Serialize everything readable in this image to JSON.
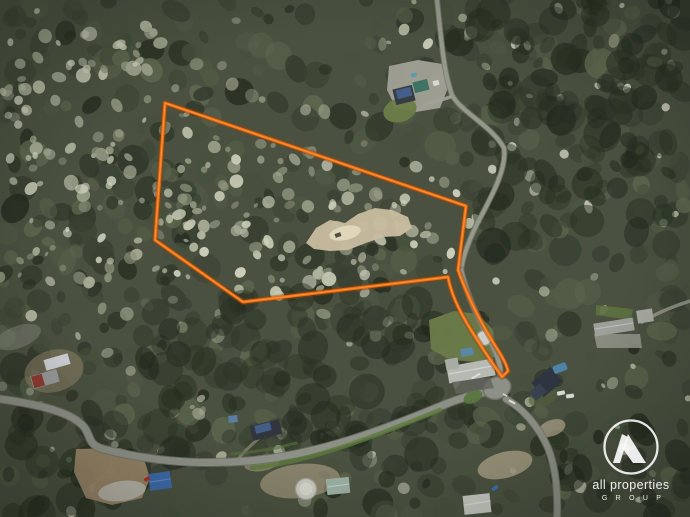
{
  "title": "Aerial drone photograph of a wooded acreage property with an orange lot-boundary overlay",
  "watermark": {
    "icon": "all-properties-a-monogram-icon",
    "line1": "all properties",
    "line2": "G R O U P",
    "color": "#ffffff",
    "circle": {
      "cx": 631,
      "cy": 447,
      "r": 26.5
    }
  },
  "scene": {
    "width": 690,
    "height": 517,
    "base_color": "#4a5140",
    "forest": {
      "dark": {
        "count": 560,
        "palette": [
          "#262d20",
          "#2f372a",
          "#3a4233",
          "#46503c",
          "#525c46",
          "#5f6950"
        ],
        "rmin": 5,
        "rmax": 16,
        "omin": 0.4,
        "omax": 0.85
      },
      "pale": {
        "count": 340,
        "palette": [
          "#8b917b",
          "#9ea48c",
          "#b2b69f",
          "#c5c8b2",
          "#d2d4c0"
        ],
        "rmin": 2.5,
        "rmax": 7.5,
        "omin": 0.5,
        "omax": 0.95
      },
      "deep": {
        "count": 240,
        "palette": [
          "#1f261c",
          "#27301f",
          "#2b3326"
        ],
        "rmin": 7,
        "rmax": 18,
        "omin": 0.3,
        "omax": 0.6
      }
    },
    "lot_polygon": [
      [
        165,
        103
      ],
      [
        466,
        206
      ],
      [
        458,
        270
      ],
      [
        448,
        277
      ],
      [
        243,
        302
      ],
      [
        155,
        240
      ]
    ],
    "boundary": {
      "name": "property-boundary",
      "path": "M165,103 L466,206 L458,270 C466,293 478,317 491,339 C498,350 506,362 508,371 L502,377 C493,364 482,348 471,330 C461,314 451,294 448,277 L243,302 L155,240 Z",
      "color": "#e96a0d",
      "glow": "#9c4507",
      "highlight": "#ff9a45"
    },
    "features": [
      {
        "name": "clearing-top-house-yard",
        "type": "polygon",
        "points": [
          [
            389,
            66
          ],
          [
            418,
            60
          ],
          [
            442,
            64
          ],
          [
            448,
            88
          ],
          [
            440,
            108
          ],
          [
            416,
            112
          ],
          [
            396,
            108
          ],
          [
            387,
            90
          ]
        ],
        "fill": "#a5a499",
        "opacity": 0.92
      },
      {
        "name": "clearing-lot-sand-patch",
        "type": "polygon",
        "points": [
          [
            306,
            243
          ],
          [
            316,
            228
          ],
          [
            330,
            220
          ],
          [
            345,
            223
          ],
          [
            358,
            214
          ],
          [
            375,
            208
          ],
          [
            392,
            210
          ],
          [
            408,
            217
          ],
          [
            412,
            228
          ],
          [
            400,
            236
          ],
          [
            383,
            237
          ],
          [
            366,
            243
          ],
          [
            348,
            250
          ],
          [
            330,
            251
          ],
          [
            314,
            249
          ]
        ],
        "fill": "#c8bd9f",
        "opacity": 0.95
      },
      {
        "name": "clearing-lot-sand-bright",
        "type": "ellipse",
        "cx": 345,
        "cy": 233,
        "rx": 16,
        "ry": 7,
        "rot": -12,
        "fill": "#e3dabf",
        "opacity": 0.9
      },
      {
        "name": "lot-vehicle",
        "type": "rect",
        "cx": 338,
        "cy": 235,
        "w": 6,
        "h": 4,
        "rot": -20,
        "fill": "#4a463e",
        "opacity": 0.95
      },
      {
        "name": "clearing-left-sheds",
        "type": "ellipse",
        "cx": 54,
        "cy": 371,
        "rx": 30,
        "ry": 21,
        "rot": -15,
        "fill": "#8b7e65",
        "opacity": 0.6
      },
      {
        "name": "clearing-bottom-left-dirt",
        "type": "polygon",
        "points": [
          [
            76,
            449
          ],
          [
            120,
            448
          ],
          [
            143,
            456
          ],
          [
            150,
            478
          ],
          [
            142,
            498
          ],
          [
            112,
            505
          ],
          [
            86,
            498
          ],
          [
            74,
            472
          ]
        ],
        "fill": "#9f8a6b",
        "opacity": 0.9
      },
      {
        "name": "clearing-bottom-left-rubble",
        "type": "ellipse",
        "cx": 122,
        "cy": 491,
        "rx": 24,
        "ry": 10,
        "rot": -8,
        "fill": "#b6b5ab",
        "opacity": 0.9
      },
      {
        "name": "clearing-bottom-center",
        "type": "ellipse",
        "cx": 300,
        "cy": 481,
        "rx": 40,
        "ry": 17,
        "rot": -6,
        "fill": "#a2977d",
        "opacity": 0.7
      },
      {
        "name": "clearing-bottom-center-2",
        "type": "ellipse",
        "cx": 262,
        "cy": 463,
        "rx": 18,
        "ry": 8,
        "rot": -10,
        "fill": "#ab9f85",
        "opacity": 0.55
      },
      {
        "name": "clearing-bottom-right",
        "type": "ellipse",
        "cx": 505,
        "cy": 465,
        "rx": 28,
        "ry": 13,
        "rot": -14,
        "fill": "#a89d83",
        "opacity": 0.8
      },
      {
        "name": "clearing-junction-gravel",
        "type": "ellipse",
        "cx": 552,
        "cy": 428,
        "rx": 14,
        "ry": 8,
        "rot": -20,
        "fill": "#b0a58b",
        "opacity": 0.7
      },
      {
        "name": "clearing-right-mid-driveway",
        "type": "polygon",
        "points": [
          [
            594,
            334
          ],
          [
            640,
            334
          ],
          [
            642,
            348
          ],
          [
            597,
            348
          ]
        ],
        "fill": "#8f9187",
        "opacity": 0.9
      },
      {
        "name": "clearing-left-edge",
        "type": "ellipse",
        "cx": 18,
        "cy": 337,
        "rx": 24,
        "ry": 11,
        "rot": -20,
        "fill": "#8c8f81",
        "opacity": 0.45
      },
      {
        "name": "lawn-top-house",
        "type": "ellipse",
        "cx": 400,
        "cy": 110,
        "rx": 17,
        "ry": 12,
        "rot": -18,
        "fill": "#6d7d49",
        "opacity": 0.95
      },
      {
        "name": "lawn-mid-house",
        "type": "polygon",
        "points": [
          [
            429,
            320
          ],
          [
            454,
            311
          ],
          [
            478,
            314
          ],
          [
            493,
            330
          ],
          [
            496,
            356
          ],
          [
            482,
            362
          ],
          [
            450,
            360
          ],
          [
            431,
            349
          ]
        ],
        "fill": "#6b7b49",
        "opacity": 0.97
      },
      {
        "name": "lawn-right-mid",
        "type": "polygon",
        "points": [
          [
            596,
            305
          ],
          [
            633,
            309
          ],
          [
            631,
            320
          ],
          [
            596,
            315
          ]
        ],
        "fill": "#5e7040",
        "opacity": 0.9
      },
      {
        "name": "lawn-bottom-right-house",
        "type": "ellipse",
        "cx": 543,
        "cy": 397,
        "rx": 15,
        "ry": 9,
        "rot": -20,
        "fill": "#535f3c",
        "opacity": 0.6
      },
      {
        "name": "road-main",
        "type": "road",
        "d": "M0,399 C50,406 74,415 84,427 C91,436 88,445 103,449 C150,461 200,465 248,461 C320,455 388,428 446,404 C458,399 472,395 486,392",
        "w": 7,
        "color": "#8d9086",
        "casing": "#6e7267"
      },
      {
        "name": "road-se-branch",
        "type": "road",
        "d": "M506,399 C522,408 538,425 548,448 C556,468 558,492 557,517",
        "w": 6,
        "color": "#8a8d83",
        "casing": "#6e7267"
      },
      {
        "name": "track-north",
        "type": "road",
        "d": "M437,0 C441,35 443,70 452,95 C461,112 492,126 504,148 C507,168 492,196 478,222 C469,240 463,256 461,270",
        "w": 4,
        "color": "#9a9d90",
        "casing": "#777b6e",
        "opacity": 0.9
      },
      {
        "name": "driveway-corridor",
        "type": "road",
        "d": "M461,270 C466,292 476,315 489,339 C497,353 502,366 500,381",
        "w": 4.5,
        "color": "#94978c",
        "casing": "#747870",
        "opacity": 0.95
      },
      {
        "name": "driveway-top-house",
        "type": "road",
        "d": "M450,97 C442,100 434,102 426,104",
        "w": 3.5,
        "color": "#a3a296",
        "opacity": 0.9
      },
      {
        "name": "track-right-mid",
        "type": "road",
        "d": "M690,301 C671,307 655,314 642,322",
        "w": 3.5,
        "color": "#97988d",
        "opacity": 0.85
      },
      {
        "name": "driveway-house-250",
        "type": "road",
        "d": "M258,439 C250,446 244,452 239,458",
        "w": 3,
        "color": "#8f8a78",
        "opacity": 0.7
      },
      {
        "name": "verge-main-road-south",
        "type": "path",
        "d": "M252,468 C312,462 380,434 440,410",
        "stroke": "#5d7a3c",
        "w": 4.5,
        "opacity": 0.8
      },
      {
        "name": "verge-main-road-north",
        "type": "path",
        "d": "M232,454 C258,452 278,448 296,443",
        "stroke": "#577238",
        "w": 3,
        "opacity": 0.6
      },
      {
        "name": "culdesac-bulb",
        "type": "ellipse",
        "cx": 497,
        "cy": 388,
        "rx": 14,
        "ry": 11,
        "rot": -18,
        "fill": "#8d9086",
        "stroke": "#6e7267",
        "sw": 1.5
      },
      {
        "name": "culdesac-island",
        "type": "ellipse",
        "cx": 473,
        "cy": 397,
        "rx": 10,
        "ry": 6,
        "rot": -24,
        "fill": "#5a7540",
        "opacity": 0.95
      },
      {
        "name": "road-marking-1",
        "type": "rect",
        "cx": 512,
        "cy": 402,
        "w": 7,
        "h": 2,
        "rot": 28,
        "fill": "#e7e7df",
        "opacity": 0.9
      },
      {
        "name": "road-marking-2",
        "type": "rect",
        "cx": 505,
        "cy": 395,
        "w": 5,
        "h": 1.6,
        "rot": 28,
        "fill": "#e7e7df",
        "opacity": 0.8
      },
      {
        "name": "building-top-house-roof",
        "type": "rect",
        "cx": 404,
        "cy": 95,
        "w": 20,
        "h": 16,
        "rot": -14,
        "fill": "#383d44"
      },
      {
        "name": "solar-panel-top-house",
        "type": "rect",
        "cx": 404,
        "cy": 93,
        "w": 15,
        "h": 9,
        "rot": -14,
        "fill": "#45618d",
        "opacity": 0.95
      },
      {
        "name": "building-top-green-roof",
        "type": "rect",
        "cx": 421,
        "cy": 86,
        "w": 15,
        "h": 11,
        "rot": -14,
        "fill": "#3e7262"
      },
      {
        "name": "structure-top-white",
        "type": "rect",
        "cx": 436,
        "cy": 83,
        "w": 6,
        "h": 5,
        "rot": -14,
        "fill": "#d9d9d1"
      },
      {
        "name": "pool-top-house",
        "type": "rect",
        "cx": 414,
        "cy": 75,
        "w": 6,
        "h": 4,
        "rot": -14,
        "fill": "#5b9ab0",
        "rx": 1.5
      },
      {
        "name": "building-mid-house-roof",
        "type": "rect",
        "cx": 471,
        "cy": 371,
        "w": 47,
        "h": 17,
        "rot": -10,
        "fill": "#b7bab2"
      },
      {
        "name": "building-mid-house-wing",
        "type": "rect",
        "cx": 452,
        "cy": 364,
        "w": 13,
        "h": 11,
        "rot": -10,
        "fill": "#a9aca4"
      },
      {
        "name": "ridge-mid-house",
        "type": "line",
        "x1": 449,
        "y1": 374,
        "x2": 492,
        "y2": 366,
        "stroke": "#d3d6ce",
        "w": 1.2,
        "opacity": 0.9
      },
      {
        "name": "trampoline-mid-house",
        "type": "circle",
        "cx": 484,
        "cy": 338,
        "r": 7.5,
        "fill": "#c9cec6",
        "stroke": "#8f958a",
        "sw": 1.2
      },
      {
        "name": "pool-mid-house",
        "type": "rect",
        "cx": 467,
        "cy": 352,
        "w": 13,
        "h": 8,
        "rot": -10,
        "fill": "#5b87a6",
        "rx": 2
      },
      {
        "name": "driveway-mid-house",
        "type": "polygon",
        "points": [
          [
            452,
            382
          ],
          [
            490,
            377
          ],
          [
            494,
            388
          ],
          [
            456,
            394
          ]
        ],
        "fill": "#62645e",
        "opacity": 0.8
      },
      {
        "name": "building-bottom-right-house",
        "type": "rect",
        "cx": 547,
        "cy": 382,
        "w": 25,
        "h": 19,
        "rot": -40,
        "fill": "#2e3440"
      },
      {
        "name": "building-bottom-right-wing",
        "type": "rect",
        "cx": 538,
        "cy": 392,
        "w": 14,
        "h": 11,
        "rot": -40,
        "fill": "#39404e"
      },
      {
        "name": "pool-bottom-right",
        "type": "rect",
        "cx": 560,
        "cy": 368,
        "w": 14,
        "h": 8,
        "rot": -20,
        "fill": "#4f82a8",
        "rx": 2
      },
      {
        "name": "caravan-1",
        "type": "rect",
        "cx": 561,
        "cy": 393,
        "w": 8,
        "h": 4,
        "rot": -12,
        "fill": "#d8d9d3",
        "rx": 1
      },
      {
        "name": "caravan-2",
        "type": "rect",
        "cx": 570,
        "cy": 396,
        "w": 8,
        "h": 4,
        "rot": -8,
        "fill": "#d8d9d3",
        "rx": 1
      },
      {
        "name": "building-right-mid-long",
        "type": "rect",
        "cx": 614,
        "cy": 327,
        "w": 40,
        "h": 13,
        "rot": -9,
        "fill": "#9da09a"
      },
      {
        "name": "ridge-right-mid-long",
        "type": "line",
        "x1": 595,
        "y1": 329,
        "x2": 633,
        "y2": 323,
        "stroke": "#b9bcb4",
        "w": 1.2
      },
      {
        "name": "building-right-mid-small",
        "type": "rect",
        "cx": 645,
        "cy": 316,
        "w": 16,
        "h": 13,
        "rot": -9,
        "fill": "#a6a9a1"
      },
      {
        "name": "shed-left-white",
        "type": "rect",
        "cx": 57,
        "cy": 362,
        "w": 25,
        "h": 11,
        "rot": -16,
        "fill": "#cdd0d4"
      },
      {
        "name": "shed-left-red",
        "type": "rect",
        "cx": 45,
        "cy": 379,
        "w": 27,
        "h": 13,
        "rot": -16,
        "fill": "#97999a"
      },
      {
        "name": "shed-left-red-stripe",
        "type": "rect",
        "cx": 38,
        "cy": 381,
        "w": 11,
        "h": 12,
        "rot": -16,
        "fill": "#8e3a30"
      },
      {
        "name": "building-house-250-roof",
        "type": "rect",
        "cx": 266,
        "cy": 430,
        "w": 30,
        "h": 15,
        "rot": -14,
        "fill": "#31363e"
      },
      {
        "name": "solar-panel-house-250",
        "type": "rect",
        "cx": 263,
        "cy": 428,
        "w": 16,
        "h": 8,
        "rot": -14,
        "fill": "#44608a",
        "opacity": 0.95
      },
      {
        "name": "tarp-structure",
        "type": "rect",
        "cx": 233,
        "cy": 419,
        "w": 9,
        "h": 7,
        "rot": -6,
        "fill": "#5b7ca3"
      },
      {
        "name": "shed-blue-roof",
        "type": "rect",
        "cx": 160,
        "cy": 481,
        "w": 22,
        "h": 17,
        "rot": -8,
        "fill": "#3d69a8"
      },
      {
        "name": "ridge-shed-blue",
        "type": "line",
        "x1": 150,
        "y1": 482,
        "x2": 170,
        "y2": 479,
        "stroke": "#5c85c0",
        "w": 1.2
      },
      {
        "name": "car-red",
        "type": "rect",
        "cx": 147,
        "cy": 479,
        "w": 6,
        "h": 3.5,
        "rot": -30,
        "fill": "#aa2f24",
        "rx": 1
      },
      {
        "name": "water-tank-round",
        "type": "circle",
        "cx": 306,
        "cy": 489,
        "r": 10.5,
        "fill": "#c6c8bd",
        "stroke": "#9fa196",
        "sw": 1.2
      },
      {
        "name": "water-tank-inner",
        "type": "circle",
        "cx": 306,
        "cy": 489,
        "r": 6.5,
        "fill": "#d5d7cc",
        "opacity": 0.9
      },
      {
        "name": "building-bottom-center",
        "type": "rect",
        "cx": 338,
        "cy": 486,
        "w": 23,
        "h": 16,
        "rot": -6,
        "fill": "#9cb0a3"
      },
      {
        "name": "ridge-building-bottom-center",
        "type": "line",
        "x1": 328,
        "y1": 487,
        "x2": 349,
        "y2": 484,
        "stroke": "#c0cfc4",
        "w": 1.1
      },
      {
        "name": "shed-bottom-right-corner",
        "type": "rect",
        "cx": 477,
        "cy": 504,
        "w": 27,
        "h": 19,
        "rot": -6,
        "fill": "#c3c6be"
      },
      {
        "name": "ridge-shed-corner",
        "type": "line",
        "x1": 465,
        "y1": 505,
        "x2": 490,
        "y2": 501,
        "stroke": "#d7dad2",
        "w": 1.2
      },
      {
        "name": "car-blue",
        "type": "rect",
        "cx": 495,
        "cy": 488,
        "w": 7,
        "h": 3.5,
        "rot": -35,
        "fill": "#3a6fae",
        "rx": 1
      },
      {
        "name": "fence-white-junction",
        "type": "rect",
        "cx": 476,
        "cy": 376,
        "w": 10,
        "h": 1.8,
        "rot": -30,
        "fill": "#e9e9e1",
        "opacity": 0.85
      }
    ]
  }
}
